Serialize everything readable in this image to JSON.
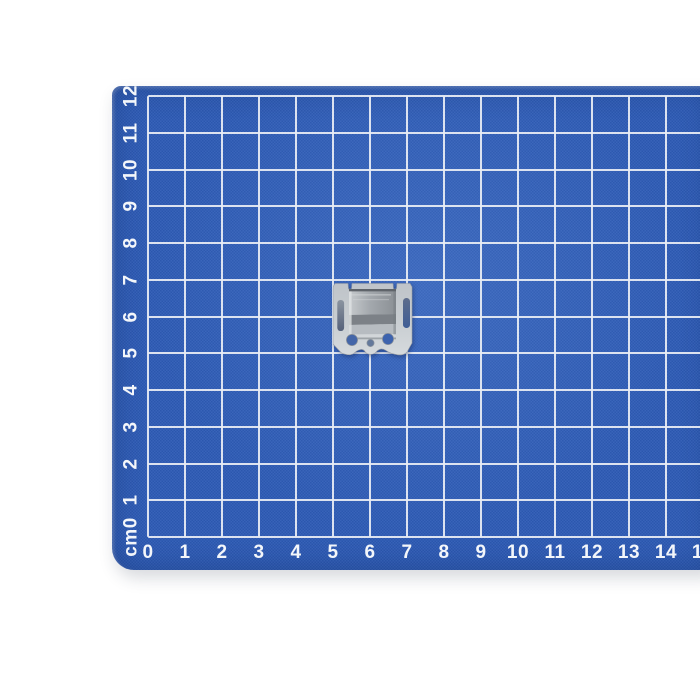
{
  "scene": {
    "background_color": "#ffffff",
    "description": "small galvanized metal mounting clip photographed on a blue self-healing cutting mat with centimetre grid"
  },
  "mat": {
    "surface_color": "#2d5bb5",
    "grid_line_color": "#e8edf4",
    "label_color": "#f3f6fa",
    "unit": "cm",
    "x_axis_labels": [
      "0",
      "1",
      "2",
      "3",
      "4",
      "5",
      "6",
      "7",
      "8",
      "9",
      "10",
      "11",
      "12",
      "13",
      "14",
      "15"
    ],
    "y_axis_labels": [
      "cm0",
      "1",
      "2",
      "3",
      "4",
      "5",
      "6",
      "7",
      "8",
      "9",
      "10",
      "11",
      "12"
    ]
  },
  "object": {
    "name": "galvanized metal mounting clip",
    "plate_color": "#c4c9ce",
    "box_top_color": "#a8adb2",
    "box_front_dark_color": "#7c8187",
    "box_front_light_color": "#b7bcc1",
    "hole_color": "#3d63ae",
    "position_cm": {
      "x_from": 5.0,
      "x_to": 7.2,
      "y_from": 4.8,
      "y_to": 6.9
    }
  }
}
